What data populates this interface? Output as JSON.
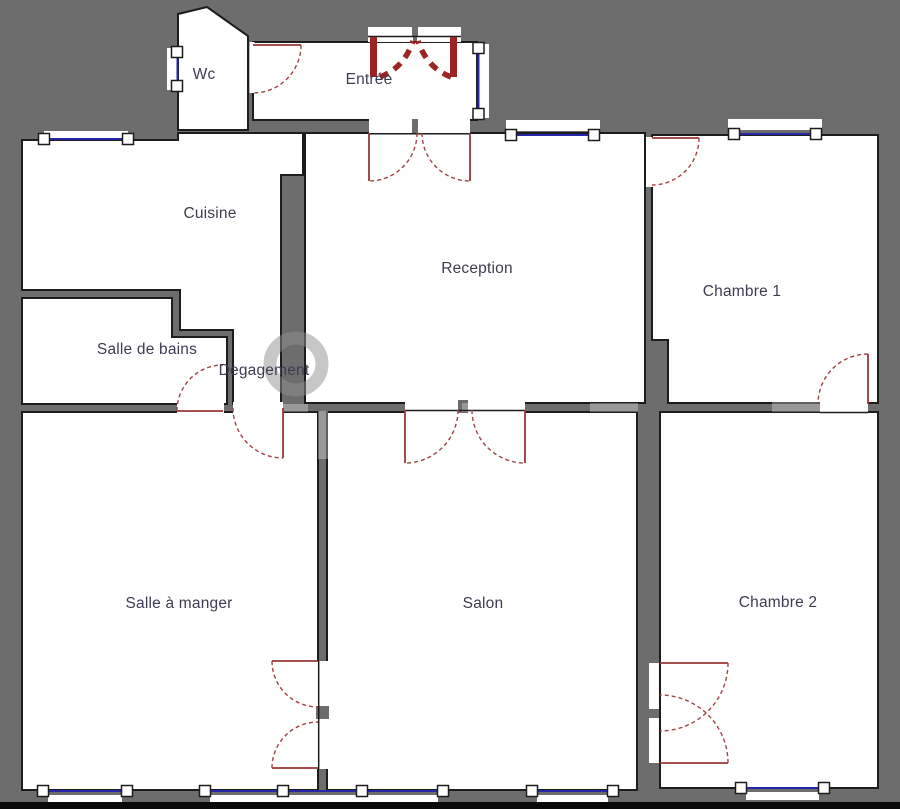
{
  "plan": {
    "rooms": [
      {
        "id": "wc",
        "label": "Wc"
      },
      {
        "id": "entree",
        "label": "Entrée"
      },
      {
        "id": "cuisine",
        "label": "Cuisine"
      },
      {
        "id": "reception",
        "label": "Reception"
      },
      {
        "id": "chambre-1",
        "label": "Chambre 1"
      },
      {
        "id": "salle-de-bains",
        "label": "Salle de bains"
      },
      {
        "id": "degagement",
        "label": "Degagement"
      },
      {
        "id": "salle-a-manger",
        "label": "Salle à manger"
      },
      {
        "id": "salon",
        "label": "Salon"
      },
      {
        "id": "chambre-2",
        "label": "Chambre 2"
      }
    ],
    "doors": [
      "entrance-double-door",
      "wc-door",
      "entree-reception-double-door",
      "reception-chambre1-door",
      "chambre1-chambre2-door",
      "reception-salon-double-door",
      "salle-de-bains-door",
      "degagement-salle-a-manger-door",
      "salle-a-manger-salon-double-door",
      "salon-chambre2-double-door"
    ],
    "windows": [
      "wc-window",
      "cuisine-window",
      "entree-window",
      "reception-window",
      "chambre1-window",
      "salle-a-manger-window-1",
      "salle-a-manger-window-2",
      "salle-a-manger-window-3",
      "salon-window-1",
      "salon-window-2",
      "chambre2-window"
    ],
    "colors": {
      "wall": "#6d6d6d",
      "room_fill": "#ffffff",
      "outline": "#1d1d1d",
      "door_red": "#993636",
      "entrance_door_red": "#9b2424",
      "window_blue": "#2626a8",
      "label_text": "#3d3d52"
    }
  }
}
